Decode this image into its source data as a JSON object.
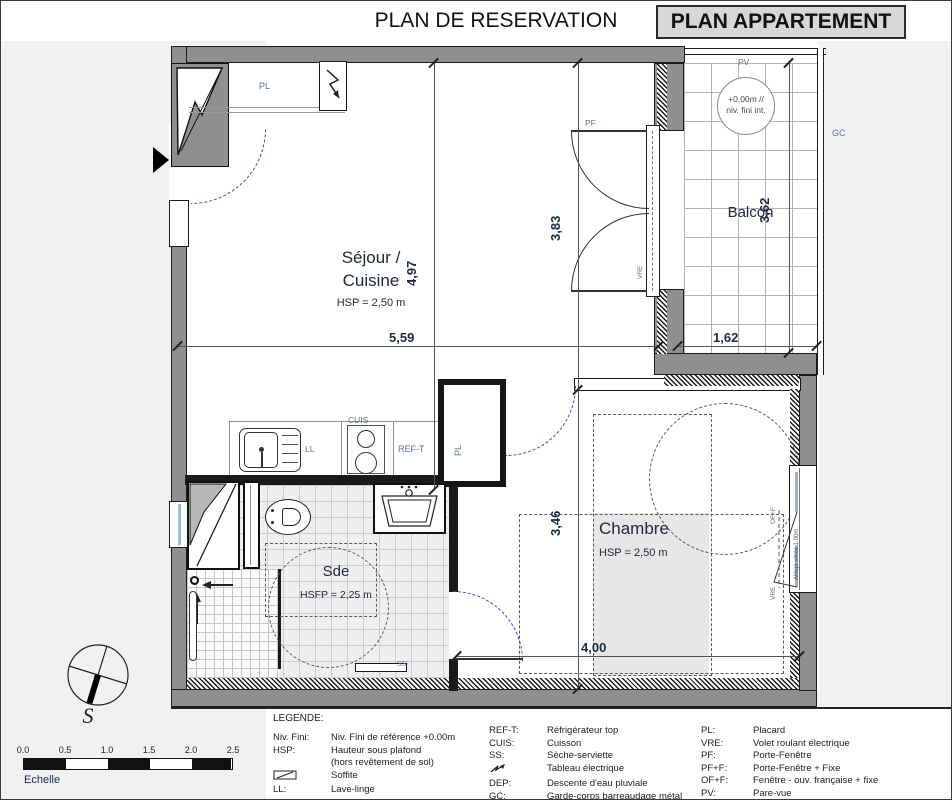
{
  "header": {
    "title": "PLAN DE RESERVATION",
    "badge": "PLAN APPARTEMENT"
  },
  "rooms": {
    "sejour": {
      "line1": "Séjour /",
      "line2": "Cuisine",
      "hsp": "HSP = 2,50 m"
    },
    "chambre": {
      "name": "Chambre",
      "hsp": "HSP = 2,50 m"
    },
    "sde": {
      "name": "Sde",
      "hsfp": "HSFP = 2,25 m"
    },
    "balcon": {
      "name": "Balcon",
      "level1": "+0.00m //",
      "level2": "niv. fini int."
    }
  },
  "dims": {
    "sejour_w": "5,59",
    "sejour_h": "4,97",
    "pf_h": "3,83",
    "balcon_h": "3,62",
    "balcon_w": "1,62",
    "chambre_h": "3,46",
    "chambre_w": "4,00"
  },
  "tags": {
    "pl_entry": "PL",
    "pl_chambre": "PL",
    "ll": "LL",
    "cuis": "CUIS",
    "ref": "REF-T",
    "pf": "PF",
    "vre_pf": "VRE",
    "vre_win": "VRE",
    "off": "OF+F",
    "pv": "PV",
    "gc": "GC",
    "ss": "SS",
    "allege": "Allège vitrée 1.00m"
  },
  "compass": {
    "south": "S"
  },
  "scale": {
    "ticks": [
      "0.0",
      "0.5",
      "1.0",
      "1.5",
      "2.0",
      "2.5"
    ],
    "label": "Echelle"
  },
  "legend": {
    "heading": "LEGENDE:",
    "col1": [
      {
        "abbr": "Niv. Fini:",
        "desc": "Niv. Fini de référence +0.00m"
      },
      {
        "abbr": "HSP:",
        "desc": "Hauteur sous plafond"
      },
      {
        "abbr": "",
        "desc": "(hors revêtement de sol)"
      },
      {
        "abbr": "",
        "desc": "Soffite"
      },
      {
        "abbr": "LL:",
        "desc": "Lave-linge"
      }
    ],
    "col2": [
      {
        "abbr": "REF-T:",
        "desc": "Réfrigérateur top"
      },
      {
        "abbr": "CUIS:",
        "desc": "Cuisson"
      },
      {
        "abbr": "SS:",
        "desc": "Sèche-serviette"
      },
      {
        "abbr": "",
        "desc": "Tableau électrique"
      },
      {
        "abbr": "DEP:",
        "desc": "Descente d'eau pluviale"
      },
      {
        "abbr": "GC:",
        "desc": "Garde-corps barreaudage métal"
      }
    ],
    "col3": [
      {
        "abbr": "PL:",
        "desc": "Placard"
      },
      {
        "abbr": "VRE:",
        "desc": "Volet roulant électrique"
      },
      {
        "abbr": "PF:",
        "desc": "Porte-Fenêtre"
      },
      {
        "abbr": "PF+F:",
        "desc": "Porte-Fenêtre + Fixe"
      },
      {
        "abbr": "OF+F:",
        "desc": "Fenêtre - ouv. française + fixe"
      },
      {
        "abbr": "PV:",
        "desc": "Pare-vue"
      }
    ]
  }
}
